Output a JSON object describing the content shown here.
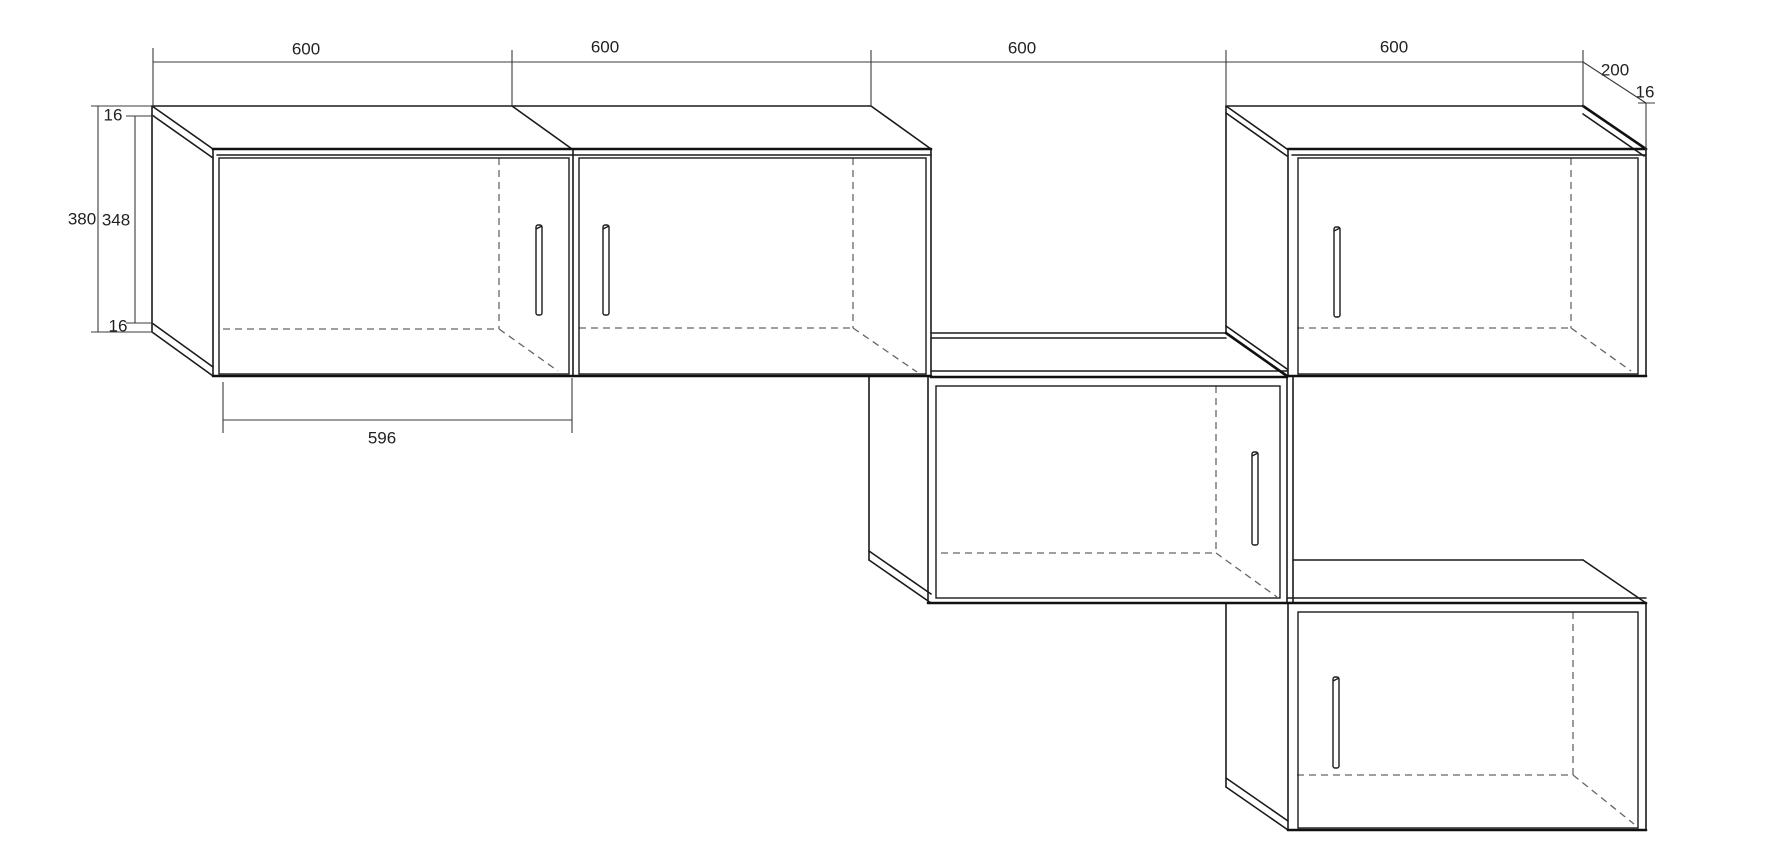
{
  "drawing": {
    "title": "wall-cabinet-assembly-technical-drawing",
    "background": "#ffffff",
    "colors": {
      "outline": "#1b1b1b",
      "heavy_edge": "#111111",
      "dimension": "#3b3b3b",
      "hidden_edge": "#666666",
      "text": "#222222"
    },
    "dimension_labels": [
      {
        "id": "width-cabinet-1",
        "text": "600",
        "x": 306,
        "y": 49
      },
      {
        "id": "width-cabinet-2",
        "text": "600",
        "x": 605,
        "y": 47
      },
      {
        "id": "width-cabinet-3",
        "text": "600",
        "x": 1022,
        "y": 48
      },
      {
        "id": "width-cabinet-4",
        "text": "600",
        "x": 1394,
        "y": 47
      },
      {
        "id": "depth",
        "text": "200",
        "x": 1615,
        "y": 70
      },
      {
        "id": "panel-16-right",
        "text": "16",
        "x": 1645,
        "y": 92
      },
      {
        "id": "panel-16-top",
        "text": "16",
        "x": 113,
        "y": 115
      },
      {
        "id": "height-overall",
        "text": "380",
        "x": 82,
        "y": 219
      },
      {
        "id": "height-inner",
        "text": "348",
        "x": 116,
        "y": 220
      },
      {
        "id": "panel-16-bottom",
        "text": "16",
        "x": 118,
        "y": 326
      },
      {
        "id": "door-width",
        "text": "596",
        "x": 382,
        "y": 438
      }
    ],
    "lines": {
      "solid": [
        [
          153,
          106,
          871,
          106
        ],
        [
          152,
          106,
          152,
          332
        ],
        [
          152,
          106,
          213,
          149
        ],
        [
          152,
          115,
          213,
          158
        ],
        [
          152,
          332,
          213,
          376
        ],
        [
          152,
          323,
          213,
          367
        ],
        [
          213,
          149,
          213,
          376
        ],
        [
          217,
          155,
          931,
          155
        ],
        [
          512,
          106,
          572,
          149
        ],
        [
          573,
          149,
          573,
          376
        ],
        [
          871,
          106,
          931,
          149
        ],
        [
          931,
          149,
          931,
          376
        ],
        [
          869,
          376,
          869,
          560
        ],
        [
          869,
          560,
          931,
          603
        ],
        [
          869,
          551,
          931,
          594
        ],
        [
          928,
          377,
          928,
          603
        ],
        [
          931,
          333,
          1226,
          333
        ],
        [
          931,
          338,
          1226,
          338
        ],
        [
          931,
          371,
          1287,
          371
        ],
        [
          1287,
          377,
          1287,
          603
        ],
        [
          1293,
          377,
          1293,
          603
        ],
        [
          1226,
          106,
          1583,
          106
        ],
        [
          1226,
          106,
          1226,
          333
        ],
        [
          1226,
          106,
          1287,
          149
        ],
        [
          1226,
          113,
          1287,
          156
        ],
        [
          1226,
          326,
          1287,
          369
        ],
        [
          1288,
          149,
          1288,
          376
        ],
        [
          1292,
          155,
          1646,
          155
        ],
        [
          1583,
          114,
          1644,
          156
        ],
        [
          1646,
          149,
          1646,
          376
        ],
        [
          1226,
          603,
          1226,
          787
        ],
        [
          1226,
          787,
          1288,
          830
        ],
        [
          1226,
          778,
          1288,
          821
        ],
        [
          1288,
          603,
          1288,
          830
        ],
        [
          1293,
          560,
          1583,
          560
        ],
        [
          1583,
          560,
          1646,
          603
        ],
        [
          1288,
          598,
          1646,
          598
        ],
        [
          1646,
          603,
          1646,
          830
        ]
      ],
      "heavy": [
        [
          213,
          149,
          931,
          149
        ],
        [
          213,
          376,
          931,
          376
        ],
        [
          931,
          377,
          1287,
          377
        ],
        [
          1226,
          333,
          1287,
          376
        ],
        [
          1288,
          149,
          1646,
          149
        ],
        [
          1583,
          106,
          1646,
          149
        ],
        [
          1288,
          376,
          1646,
          376
        ],
        [
          928,
          603,
          1646,
          603
        ],
        [
          1288,
          830,
          1646,
          830
        ]
      ],
      "dim": [
        [
          153,
          62,
          1583,
          62
        ],
        [
          153,
          48,
          153,
          106
        ],
        [
          512,
          50,
          512,
          106
        ],
        [
          871,
          50,
          871,
          106
        ],
        [
          1226,
          50,
          1226,
          106
        ],
        [
          1583,
          50,
          1583,
          107
        ],
        [
          1583,
          62,
          1646,
          103
        ],
        [
          1638,
          103,
          1655,
          103
        ],
        [
          1646,
          103,
          1646,
          150
        ],
        [
          91,
          106,
          153,
          106
        ],
        [
          126,
          116,
          155,
          116
        ],
        [
          98,
          106,
          98,
          332
        ],
        [
          135,
          116,
          135,
          323
        ],
        [
          91,
          332,
          153,
          332
        ],
        [
          126,
          323,
          153,
          323
        ],
        [
          223,
          382,
          223,
          433
        ],
        [
          572,
          378,
          572,
          433
        ],
        [
          223,
          420,
          572,
          420
        ]
      ],
      "hidden": [
        [
          499,
          158,
          499,
          329
        ],
        [
          223,
          329,
          499,
          329
        ],
        [
          499,
          329,
          558,
          371
        ],
        [
          853,
          158,
          853,
          328
        ],
        [
          579,
          328,
          853,
          328
        ],
        [
          853,
          328,
          917,
          372
        ],
        [
          1571,
          158,
          1571,
          328
        ],
        [
          1297,
          328,
          1571,
          328
        ],
        [
          1571,
          328,
          1631,
          371
        ],
        [
          1216,
          386,
          1216,
          553
        ],
        [
          941,
          553,
          1216,
          553
        ],
        [
          1216,
          553,
          1277,
          597
        ],
        [
          1573,
          612,
          1573,
          775
        ],
        [
          1297,
          775,
          1573,
          775
        ],
        [
          1573,
          775,
          1634,
          824
        ]
      ]
    },
    "doors": [
      {
        "id": "door-cabinet-1",
        "x": 219,
        "y": 158,
        "w": 350,
        "h": 216
      },
      {
        "id": "door-cabinet-2",
        "x": 579,
        "y": 158,
        "w": 347,
        "h": 216
      },
      {
        "id": "door-cabinet-3",
        "x": 936,
        "y": 386,
        "w": 344,
        "h": 212
      },
      {
        "id": "door-cabinet-4",
        "x": 1298,
        "y": 158,
        "w": 340,
        "h": 216
      },
      {
        "id": "door-cabinet-5",
        "x": 1298,
        "y": 612,
        "w": 340,
        "h": 216
      }
    ],
    "handles": [
      {
        "id": "handle-cabinet-1",
        "x": 536,
        "y": 225,
        "w": 6,
        "h": 90
      },
      {
        "id": "handle-cabinet-2",
        "x": 603,
        "y": 225,
        "w": 6,
        "h": 90
      },
      {
        "id": "handle-cabinet-3",
        "x": 1252,
        "y": 452,
        "w": 6,
        "h": 93
      },
      {
        "id": "handle-cabinet-4",
        "x": 1334,
        "y": 227,
        "w": 6,
        "h": 90
      },
      {
        "id": "handle-cabinet-5",
        "x": 1333,
        "y": 677,
        "w": 6,
        "h": 91
      }
    ]
  }
}
